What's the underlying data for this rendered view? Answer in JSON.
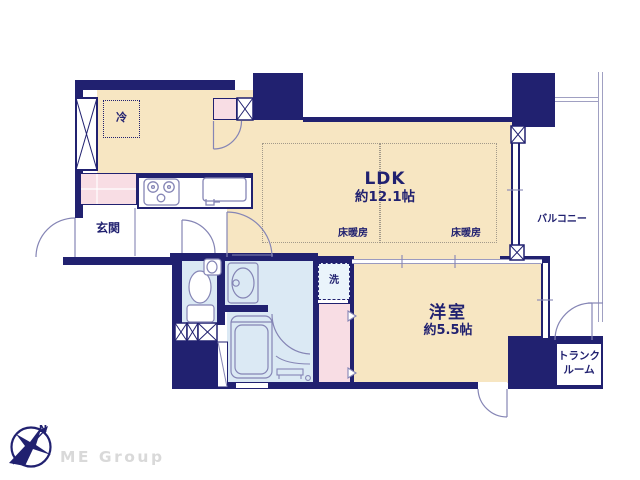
{
  "plan": {
    "labels": {
      "fridge": "冷",
      "entrance": "玄関",
      "ldk": "LDK",
      "ldk_size": "約12.1帖",
      "floor_heating_left": "床暖房",
      "floor_heating_right": "床暖房",
      "washer": "洗",
      "western_room": "洋室",
      "western_room_size": "約5.5帖",
      "balcony": "バルコニー",
      "trunk_room_line1": "トランク",
      "trunk_room_line2": "ルーム",
      "compass_north": "N",
      "watermark": "ME Group"
    },
    "colors": {
      "wall": "#212170",
      "room_fill": "#f7e6c2",
      "closet_fill": "#f8dde4",
      "wet_area_fill": "#dbe9f4",
      "washer_box_fill": "#eaf4fb",
      "fixture_line": "#8585b5",
      "watermark_gray": "#d9d9d9"
    }
  }
}
